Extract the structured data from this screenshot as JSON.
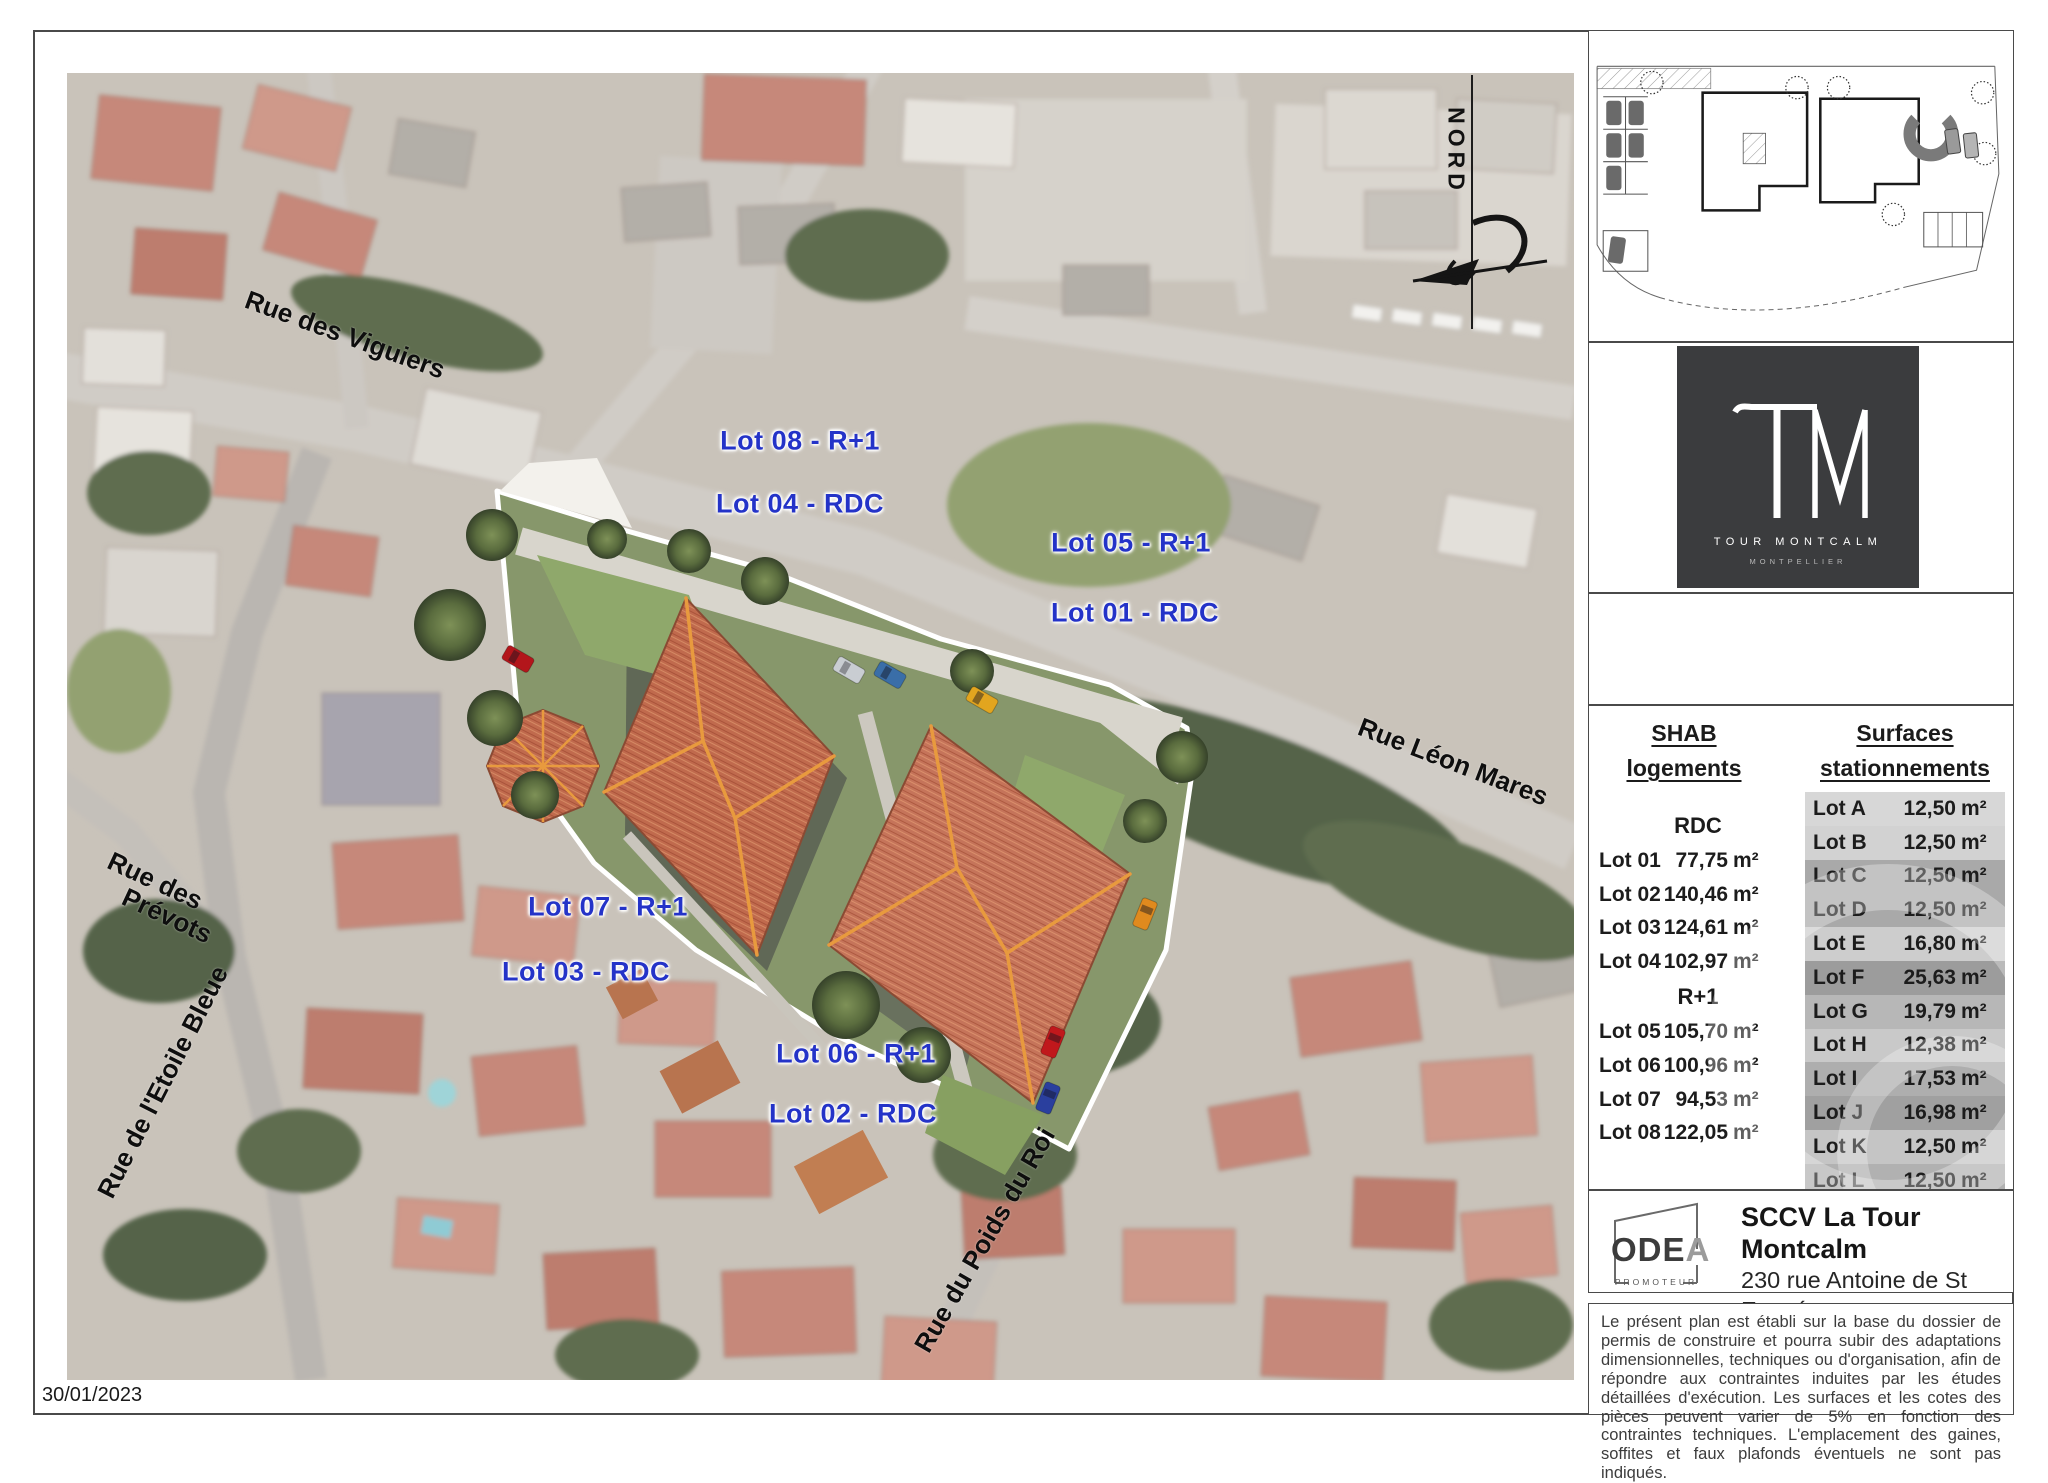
{
  "page": {
    "date": "30/01/2023"
  },
  "north": {
    "label": "NORD"
  },
  "map": {
    "lot_labels": [
      {
        "text": "Lot 08 - R+1",
        "x": 733,
        "y": 368
      },
      {
        "text": "Lot 04 - RDC",
        "x": 733,
        "y": 431
      },
      {
        "text": "Lot 05 - R+1",
        "x": 1064,
        "y": 470
      },
      {
        "text": "Lot 01 - RDC",
        "x": 1068,
        "y": 540
      },
      {
        "text": "Lot 07 - R+1",
        "x": 541,
        "y": 834
      },
      {
        "text": "Lot 03 - RDC",
        "x": 519,
        "y": 899
      },
      {
        "text": "Lot 06 - R+1",
        "x": 789,
        "y": 981
      },
      {
        "text": "Lot 02 - RDC",
        "x": 786,
        "y": 1041
      }
    ],
    "street_labels": [
      {
        "text": "Rue des Viguiers",
        "x": 278,
        "y": 262,
        "angle": 20
      },
      {
        "text": "Rue Léon Mares",
        "x": 1386,
        "y": 689,
        "angle": 21
      },
      {
        "text": "Rue des",
        "x": 88,
        "y": 808,
        "angle": 25
      },
      {
        "text": "Prévots",
        "x": 100,
        "y": 843,
        "angle": 25
      },
      {
        "text": "Rue de l'Etoile Bleue",
        "x": 96,
        "y": 1009,
        "angle": -63
      },
      {
        "text": "Rue du Poids du Roi",
        "x": 918,
        "y": 1167,
        "angle": -60
      }
    ]
  },
  "brand": {
    "monogram": "TM",
    "name": "TOUR MONTCALM",
    "city": "MONTPELLIER"
  },
  "tables": {
    "shab": {
      "title1": "SHAB",
      "title2": "logements",
      "section_rdc": "RDC",
      "section_r1": "R+1",
      "rdc_rows": [
        {
          "lot": "Lot 01",
          "value": "77,75",
          "unit": "m²"
        },
        {
          "lot": "Lot 02",
          "value": "140,46",
          "unit": "m²"
        },
        {
          "lot": "Lot 03",
          "value": "124,61",
          "unit": "m²"
        },
        {
          "lot": "Lot 04",
          "value": "102,97",
          "unit": "m²"
        }
      ],
      "r1_rows": [
        {
          "lot": "Lot 05",
          "value": "105,70",
          "unit": "m²"
        },
        {
          "lot": "Lot 06",
          "value": "100,96",
          "unit": "m²"
        },
        {
          "lot": "Lot 07",
          "value": "94,53",
          "unit": "m²"
        },
        {
          "lot": "Lot 08",
          "value": "122,05",
          "unit": "m²"
        }
      ]
    },
    "parking": {
      "title1": "Surfaces",
      "title2": "stationnements",
      "rows": [
        {
          "lot": "Lot A",
          "value": "12,50",
          "unit": "m²",
          "bg": "#d7d7d7",
          "muted": false
        },
        {
          "lot": "Lot B",
          "value": "12,50",
          "unit": "m²",
          "bg": "#d2d2d2",
          "muted": false
        },
        {
          "lot": "Lot C",
          "value": "12,50",
          "unit": "m²",
          "bg": "#a9a9a9",
          "muted": false
        },
        {
          "lot": "Lot D",
          "value": "12,50",
          "unit": "m²",
          "bg": "#a9a9a9",
          "muted": false
        },
        {
          "lot": "Lot E",
          "value": "16,80",
          "unit": "m²",
          "bg": "#cdcdcd",
          "muted": false
        },
        {
          "lot": "Lot F",
          "value": "25,63",
          "unit": "m²",
          "bg": "#9c9c9c",
          "muted": false
        },
        {
          "lot": "Lot G",
          "value": "19,79",
          "unit": "m²",
          "bg": "#b7b7b7",
          "muted": true
        },
        {
          "lot": "Lot H",
          "value": "12,38",
          "unit": "m²",
          "bg": "#c9c9c9",
          "muted": false
        },
        {
          "lot": "Lot I",
          "value": "17,53",
          "unit": "m²",
          "bg": "#aeaeae",
          "muted": false
        },
        {
          "lot": "Lot J",
          "value": "16,98",
          "unit": "m²",
          "bg": "#a0a0a0",
          "muted": false
        },
        {
          "lot": "Lot K",
          "value": "12,50",
          "unit": "m²",
          "bg": "#c5c5c5",
          "muted": false
        },
        {
          "lot": "Lot L",
          "value": "12,50",
          "unit": "m²",
          "bg": "#b1b1b1",
          "muted": false
        }
      ]
    }
  },
  "promoter": {
    "logo": "ODEA",
    "logo_sub": "PROMOTEUR",
    "company": "SCCV La Tour Montcalm",
    "address1": "230 rue Antoine de St Exupéry",
    "address2": "34130 Mauguio"
  },
  "legal": "Le présent plan est établi sur la base du dossier de permis de construire et pourra subir des adaptations dimensionnelles, techniques ou d'organisation, afin de répondre aux contraintes induites par les études détaillées d'exécution. Les surfaces et les cotes des pièces peuvent varier de 5% en fonction des contraintes techniques. L'emplacement des gaines, soffites et faux plafonds éventuels ne sont pas indiqués."
}
